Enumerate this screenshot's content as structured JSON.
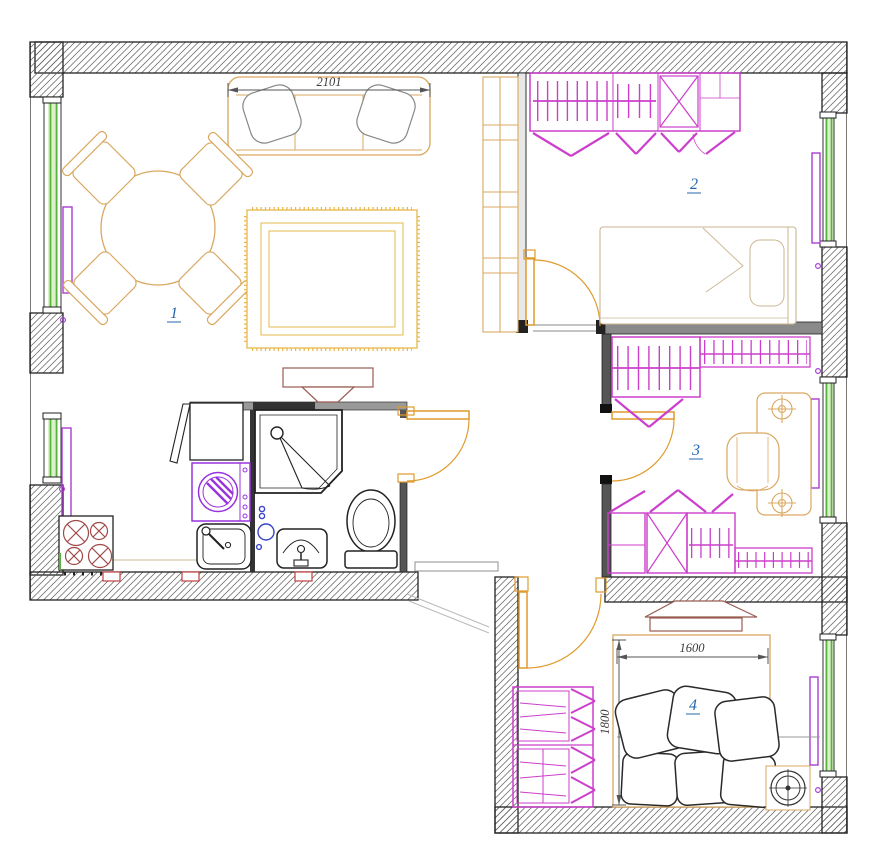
{
  "title": "Apartment floor plan",
  "rooms": [
    {
      "number": "1",
      "name": "living-room-kitchen"
    },
    {
      "number": "2",
      "name": "bedroom"
    },
    {
      "number": "3",
      "name": "study"
    },
    {
      "number": "4",
      "name": "bedroom-small"
    }
  ],
  "dimensions": {
    "sofa_width": "2101",
    "bed_width": "1600",
    "bed_length": "1800"
  },
  "colors": {
    "furniture_tan": "#D9A860",
    "wardrobe_magenta": "#CC3FCC",
    "window_green": "#57B33C",
    "radiator_purple": "#A93FD1",
    "door_orange": "#E09A2D",
    "appliance_purple": "#9933DD",
    "room_label_blue": "#2565AE",
    "burner_red": "#A04848",
    "socket_red": "#C04040",
    "tv_brown": "#9A5B52"
  },
  "symbols": [
    "sofa-icon",
    "dining-table-icon",
    "chair-icon",
    "rug-icon",
    "tv-icon",
    "bookshelf-icon",
    "stove-icon",
    "fridge-icon",
    "washing-machine-icon",
    "kitchen-sink-icon",
    "shower-icon",
    "toilet-icon",
    "washbasin-icon",
    "wardrobe-icon",
    "bed-icon",
    "desk-icon",
    "speaker-icon",
    "radiator-icon",
    "window-icon",
    "door-icon",
    "entrance-door-icon"
  ]
}
